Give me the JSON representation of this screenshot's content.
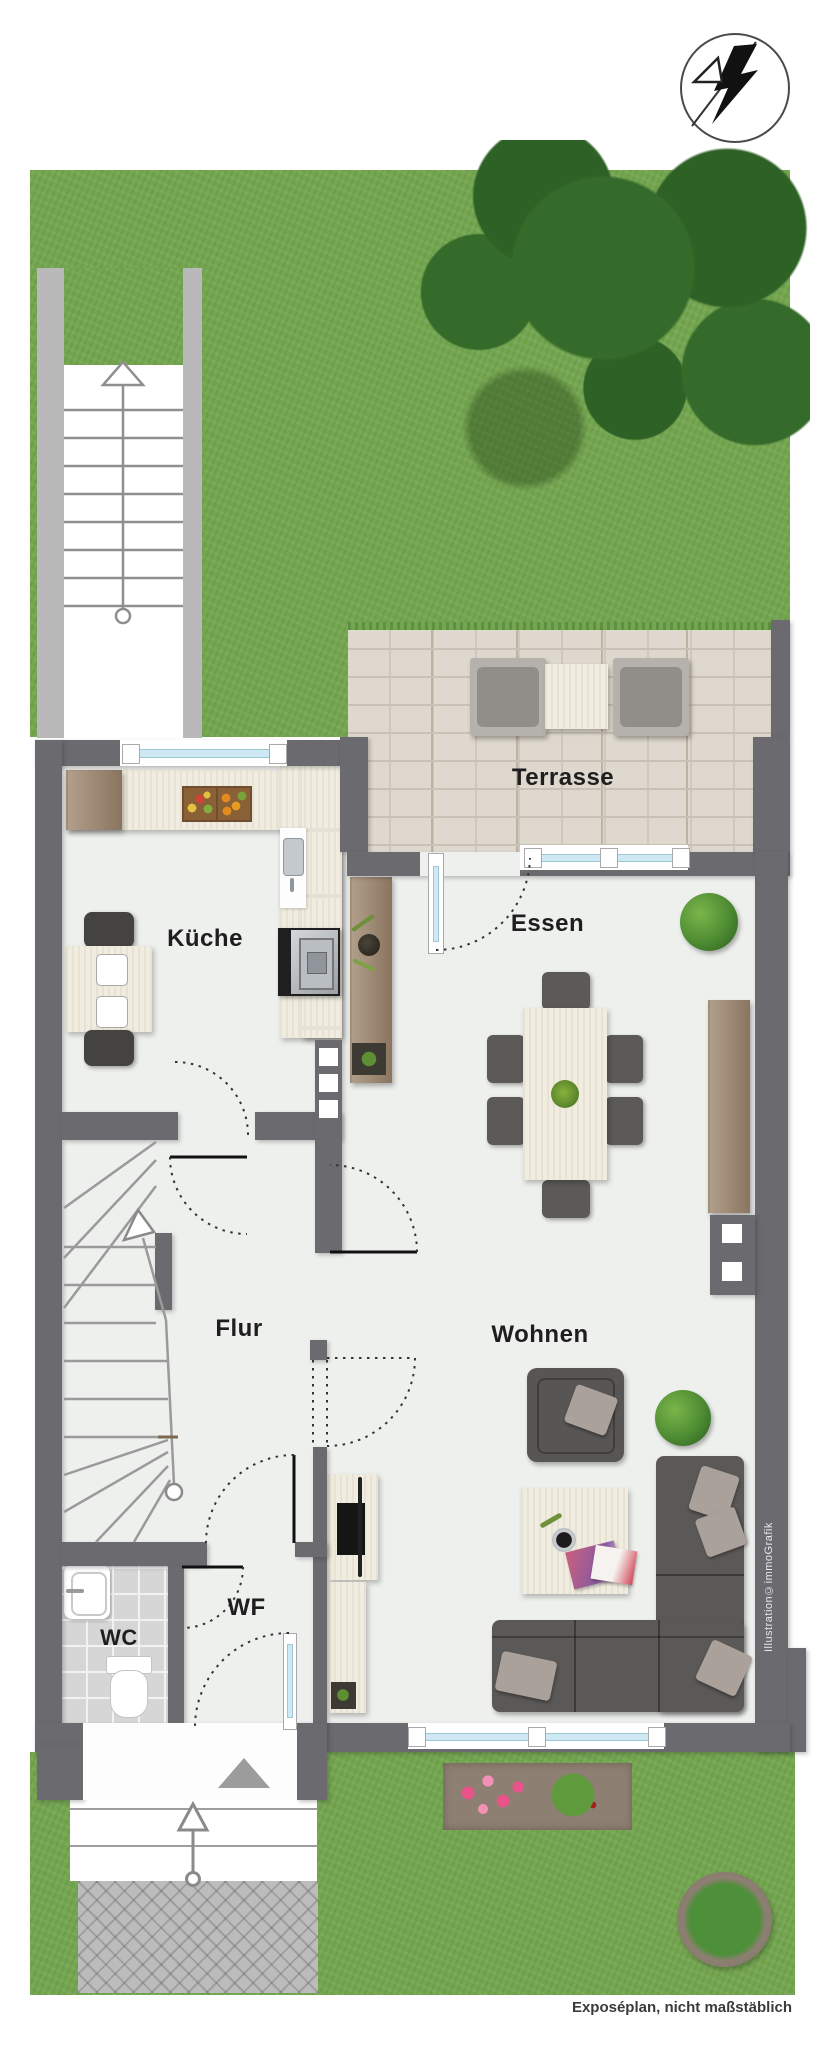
{
  "compass": {
    "icon": "north-arrow-icon"
  },
  "rooms": {
    "terrasse": {
      "label": "Terrasse"
    },
    "kueche": {
      "label": "Küche"
    },
    "essen": {
      "label": "Essen"
    },
    "flur": {
      "label": "Flur"
    },
    "wohnen": {
      "label": "Wohnen"
    },
    "wf": {
      "label": "WF"
    },
    "wc": {
      "label": "WC"
    }
  },
  "annotations": {
    "caption": "Exposéplan, nicht maßstäblich",
    "credit": "Illustration©immoGrafik"
  },
  "icons": {
    "north_arrow": "north-arrow-icon",
    "entrance_arrow": "entrance-arrow-icon",
    "stair_direction_arrow": "stair-direction-arrow-icon"
  },
  "colors": {
    "wall": "#6b6a6f",
    "floor": "#eef0ee",
    "grass": "#74a550",
    "terrace_paving": "#ded8ce",
    "glass": "#cfe9f4",
    "wood": "#a28b72",
    "cream_furniture": "#f0ecdf",
    "dark_furniture": "#5b5957",
    "wc_tile": "#d6d6d6"
  }
}
